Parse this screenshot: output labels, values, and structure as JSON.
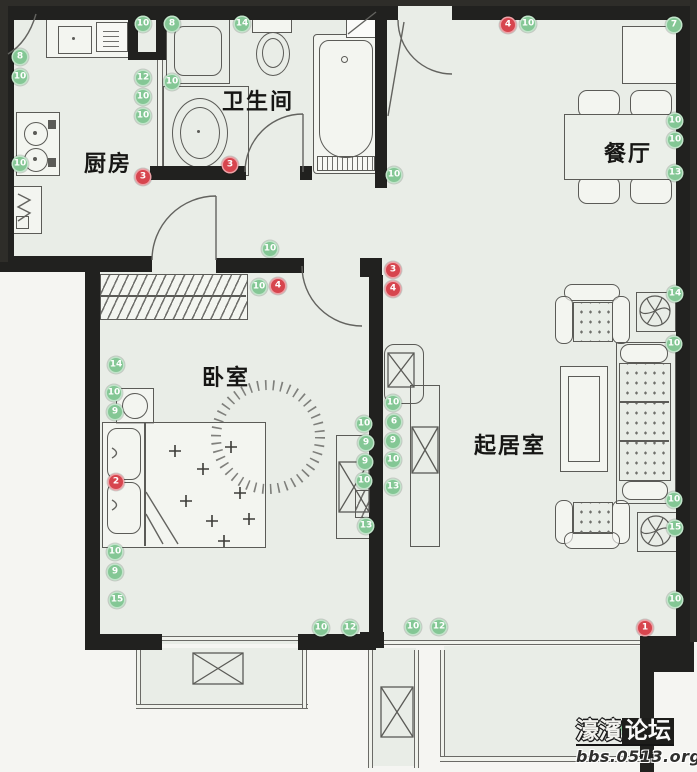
{
  "rooms": {
    "kitchen": {
      "label": "厨房"
    },
    "bathroom": {
      "label": "卫生间"
    },
    "dining": {
      "label": "餐厅"
    },
    "bedroom": {
      "label": "卧室"
    },
    "living": {
      "label": "起居室"
    }
  },
  "markers": {
    "colors": {
      "green": "#84c795",
      "red": "#d7454e"
    },
    "items": [
      {
        "x": 20,
        "y": 57,
        "type": "green",
        "value": "8"
      },
      {
        "x": 20,
        "y": 77,
        "type": "green",
        "value": "10"
      },
      {
        "x": 20,
        "y": 164,
        "type": "green",
        "value": "10"
      },
      {
        "x": 143,
        "y": 24,
        "type": "green",
        "value": "10"
      },
      {
        "x": 172,
        "y": 24,
        "type": "green",
        "value": "8"
      },
      {
        "x": 242,
        "y": 24,
        "type": "green",
        "value": "14"
      },
      {
        "x": 508,
        "y": 25,
        "type": "red",
        "value": "4"
      },
      {
        "x": 528,
        "y": 24,
        "type": "green",
        "value": "10"
      },
      {
        "x": 674,
        "y": 25,
        "type": "green",
        "value": "7"
      },
      {
        "x": 143,
        "y": 78,
        "type": "green",
        "value": "12"
      },
      {
        "x": 143,
        "y": 97,
        "type": "green",
        "value": "10"
      },
      {
        "x": 143,
        "y": 116,
        "type": "green",
        "value": "10"
      },
      {
        "x": 172,
        "y": 82,
        "type": "green",
        "value": "10"
      },
      {
        "x": 230,
        "y": 165,
        "type": "red",
        "value": "3"
      },
      {
        "x": 143,
        "y": 177,
        "type": "red",
        "value": "3"
      },
      {
        "x": 394,
        "y": 175,
        "type": "green",
        "value": "10"
      },
      {
        "x": 675,
        "y": 121,
        "type": "green",
        "value": "10"
      },
      {
        "x": 675,
        "y": 140,
        "type": "green",
        "value": "10"
      },
      {
        "x": 675,
        "y": 173,
        "type": "green",
        "value": "13"
      },
      {
        "x": 270,
        "y": 249,
        "type": "green",
        "value": "10"
      },
      {
        "x": 259,
        "y": 287,
        "type": "green",
        "value": "10"
      },
      {
        "x": 278,
        "y": 286,
        "type": "red",
        "value": "4"
      },
      {
        "x": 393,
        "y": 270,
        "type": "red",
        "value": "3"
      },
      {
        "x": 393,
        "y": 289,
        "type": "red",
        "value": "4"
      },
      {
        "x": 116,
        "y": 365,
        "type": "green",
        "value": "14"
      },
      {
        "x": 114,
        "y": 393,
        "type": "green",
        "value": "10"
      },
      {
        "x": 115,
        "y": 412,
        "type": "green",
        "value": "9"
      },
      {
        "x": 116,
        "y": 482,
        "type": "red",
        "value": "2"
      },
      {
        "x": 364,
        "y": 424,
        "type": "green",
        "value": "10"
      },
      {
        "x": 366,
        "y": 443,
        "type": "green",
        "value": "9"
      },
      {
        "x": 365,
        "y": 462,
        "type": "green",
        "value": "9"
      },
      {
        "x": 364,
        "y": 481,
        "type": "green",
        "value": "10"
      },
      {
        "x": 366,
        "y": 526,
        "type": "green",
        "value": "13"
      },
      {
        "x": 393,
        "y": 403,
        "type": "green",
        "value": "10"
      },
      {
        "x": 394,
        "y": 422,
        "type": "green",
        "value": "6"
      },
      {
        "x": 393,
        "y": 441,
        "type": "green",
        "value": "9"
      },
      {
        "x": 393,
        "y": 460,
        "type": "green",
        "value": "10"
      },
      {
        "x": 393,
        "y": 487,
        "type": "green",
        "value": "13"
      },
      {
        "x": 675,
        "y": 294,
        "type": "green",
        "value": "14"
      },
      {
        "x": 674,
        "y": 344,
        "type": "green",
        "value": "10"
      },
      {
        "x": 674,
        "y": 500,
        "type": "green",
        "value": "10"
      },
      {
        "x": 675,
        "y": 528,
        "type": "green",
        "value": "15"
      },
      {
        "x": 675,
        "y": 600,
        "type": "green",
        "value": "10"
      },
      {
        "x": 115,
        "y": 552,
        "type": "green",
        "value": "10"
      },
      {
        "x": 115,
        "y": 572,
        "type": "green",
        "value": "9"
      },
      {
        "x": 117,
        "y": 600,
        "type": "green",
        "value": "15"
      },
      {
        "x": 321,
        "y": 628,
        "type": "green",
        "value": "10"
      },
      {
        "x": 350,
        "y": 628,
        "type": "green",
        "value": "12"
      },
      {
        "x": 413,
        "y": 627,
        "type": "green",
        "value": "10"
      },
      {
        "x": 439,
        "y": 627,
        "type": "green",
        "value": "12"
      },
      {
        "x": 645,
        "y": 628,
        "type": "red",
        "value": "1"
      },
      {
        "x": 628,
        "y": 728,
        "type": "green",
        "value": ""
      }
    ]
  },
  "watermark": {
    "site_name_outline": "濠濱",
    "site_name_box": "论坛",
    "site_url": "bbs.0513.org"
  }
}
